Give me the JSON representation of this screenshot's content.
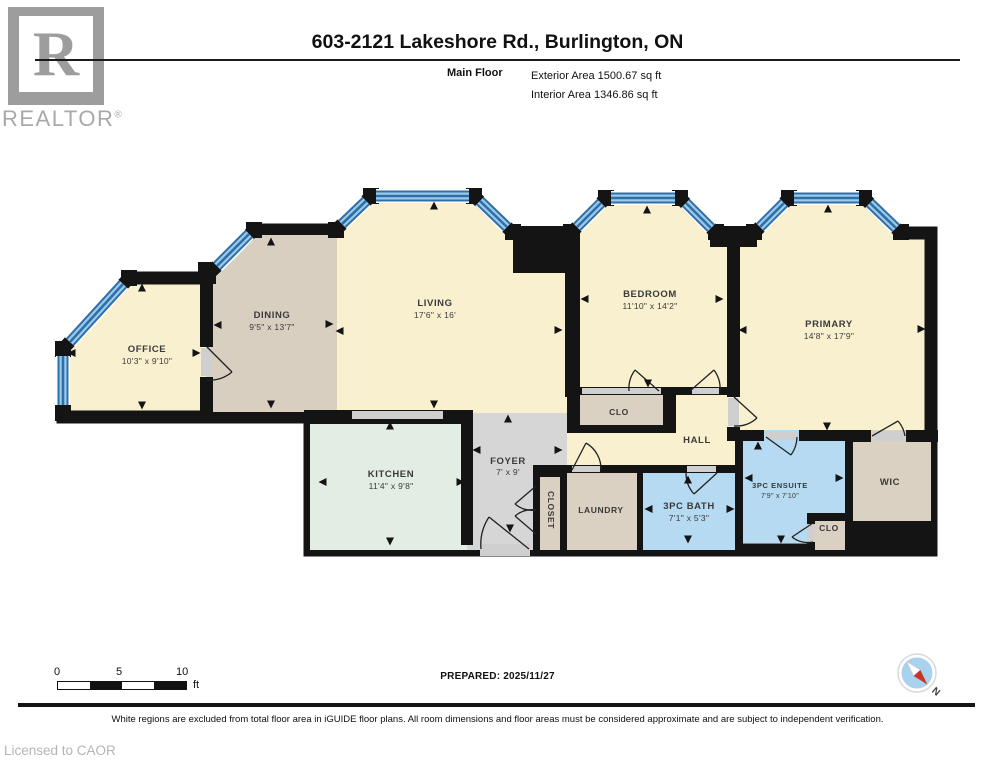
{
  "header": {
    "logo_letter": "R",
    "logo_text": "REALTOR",
    "logo_reg": "®",
    "title": "603-2121 Lakeshore Rd., Burlington, ON",
    "floor_label": "Main Floor",
    "exterior_area": "Exterior Area 1500.67 sq ft",
    "interior_area": "Interior Area 1346.86 sq ft"
  },
  "plan": {
    "colors": {
      "cream": "#F9F0CF",
      "taupe": "#D8CFC1",
      "mint": "#E2EDE4",
      "gray": "#D6D6D6",
      "tan": "#DAD1C2",
      "blue": "#B5DAF2",
      "wall": "#141414",
      "door": "#CFCFCF",
      "window_dark": "#2F6FA8",
      "window_light": "#9CCAE9",
      "compass_blue": "#A9D2EE",
      "compass_red": "#C63527"
    },
    "rooms": [
      {
        "name": "OFFICE",
        "dims": "10'3\" x 9'10\""
      },
      {
        "name": "DINING",
        "dims": "9'5\" x 13'7\""
      },
      {
        "name": "LIVING",
        "dims": "17'6\" x 16'"
      },
      {
        "name": "KITCHEN",
        "dims": "11'4\" x 9'8\""
      },
      {
        "name": "FOYER",
        "dims": "7' x 9'"
      },
      {
        "name": "CLOSET",
        "dims": ""
      },
      {
        "name": "LAUNDRY",
        "dims": ""
      },
      {
        "name": "3PC BATH",
        "dims": "7'1\" x 5'3\""
      },
      {
        "name": "CLO",
        "dims": ""
      },
      {
        "name": "HALL",
        "dims": ""
      },
      {
        "name": "BEDROOM",
        "dims": "11'10\" x 14'2\""
      },
      {
        "name": "PRIMARY",
        "dims": "14'8\" x 17'9\""
      },
      {
        "name": "3PC ENSUITE",
        "dims": "7'9\" x 7'10\""
      },
      {
        "name": "CLO",
        "dims": ""
      },
      {
        "name": "WIC",
        "dims": ""
      }
    ]
  },
  "footer": {
    "scale_labels": [
      "0",
      "5",
      "10"
    ],
    "scale_unit": "ft",
    "prepared": "PREPARED: 2025/11/27",
    "compass_n": "N",
    "disclaimer": "White regions are excluded from total floor area in iGUIDE floor plans. All room dimensions and floor areas must be considered approximate and are subject to independent verification.",
    "licensed": "Licensed to CAOR"
  }
}
